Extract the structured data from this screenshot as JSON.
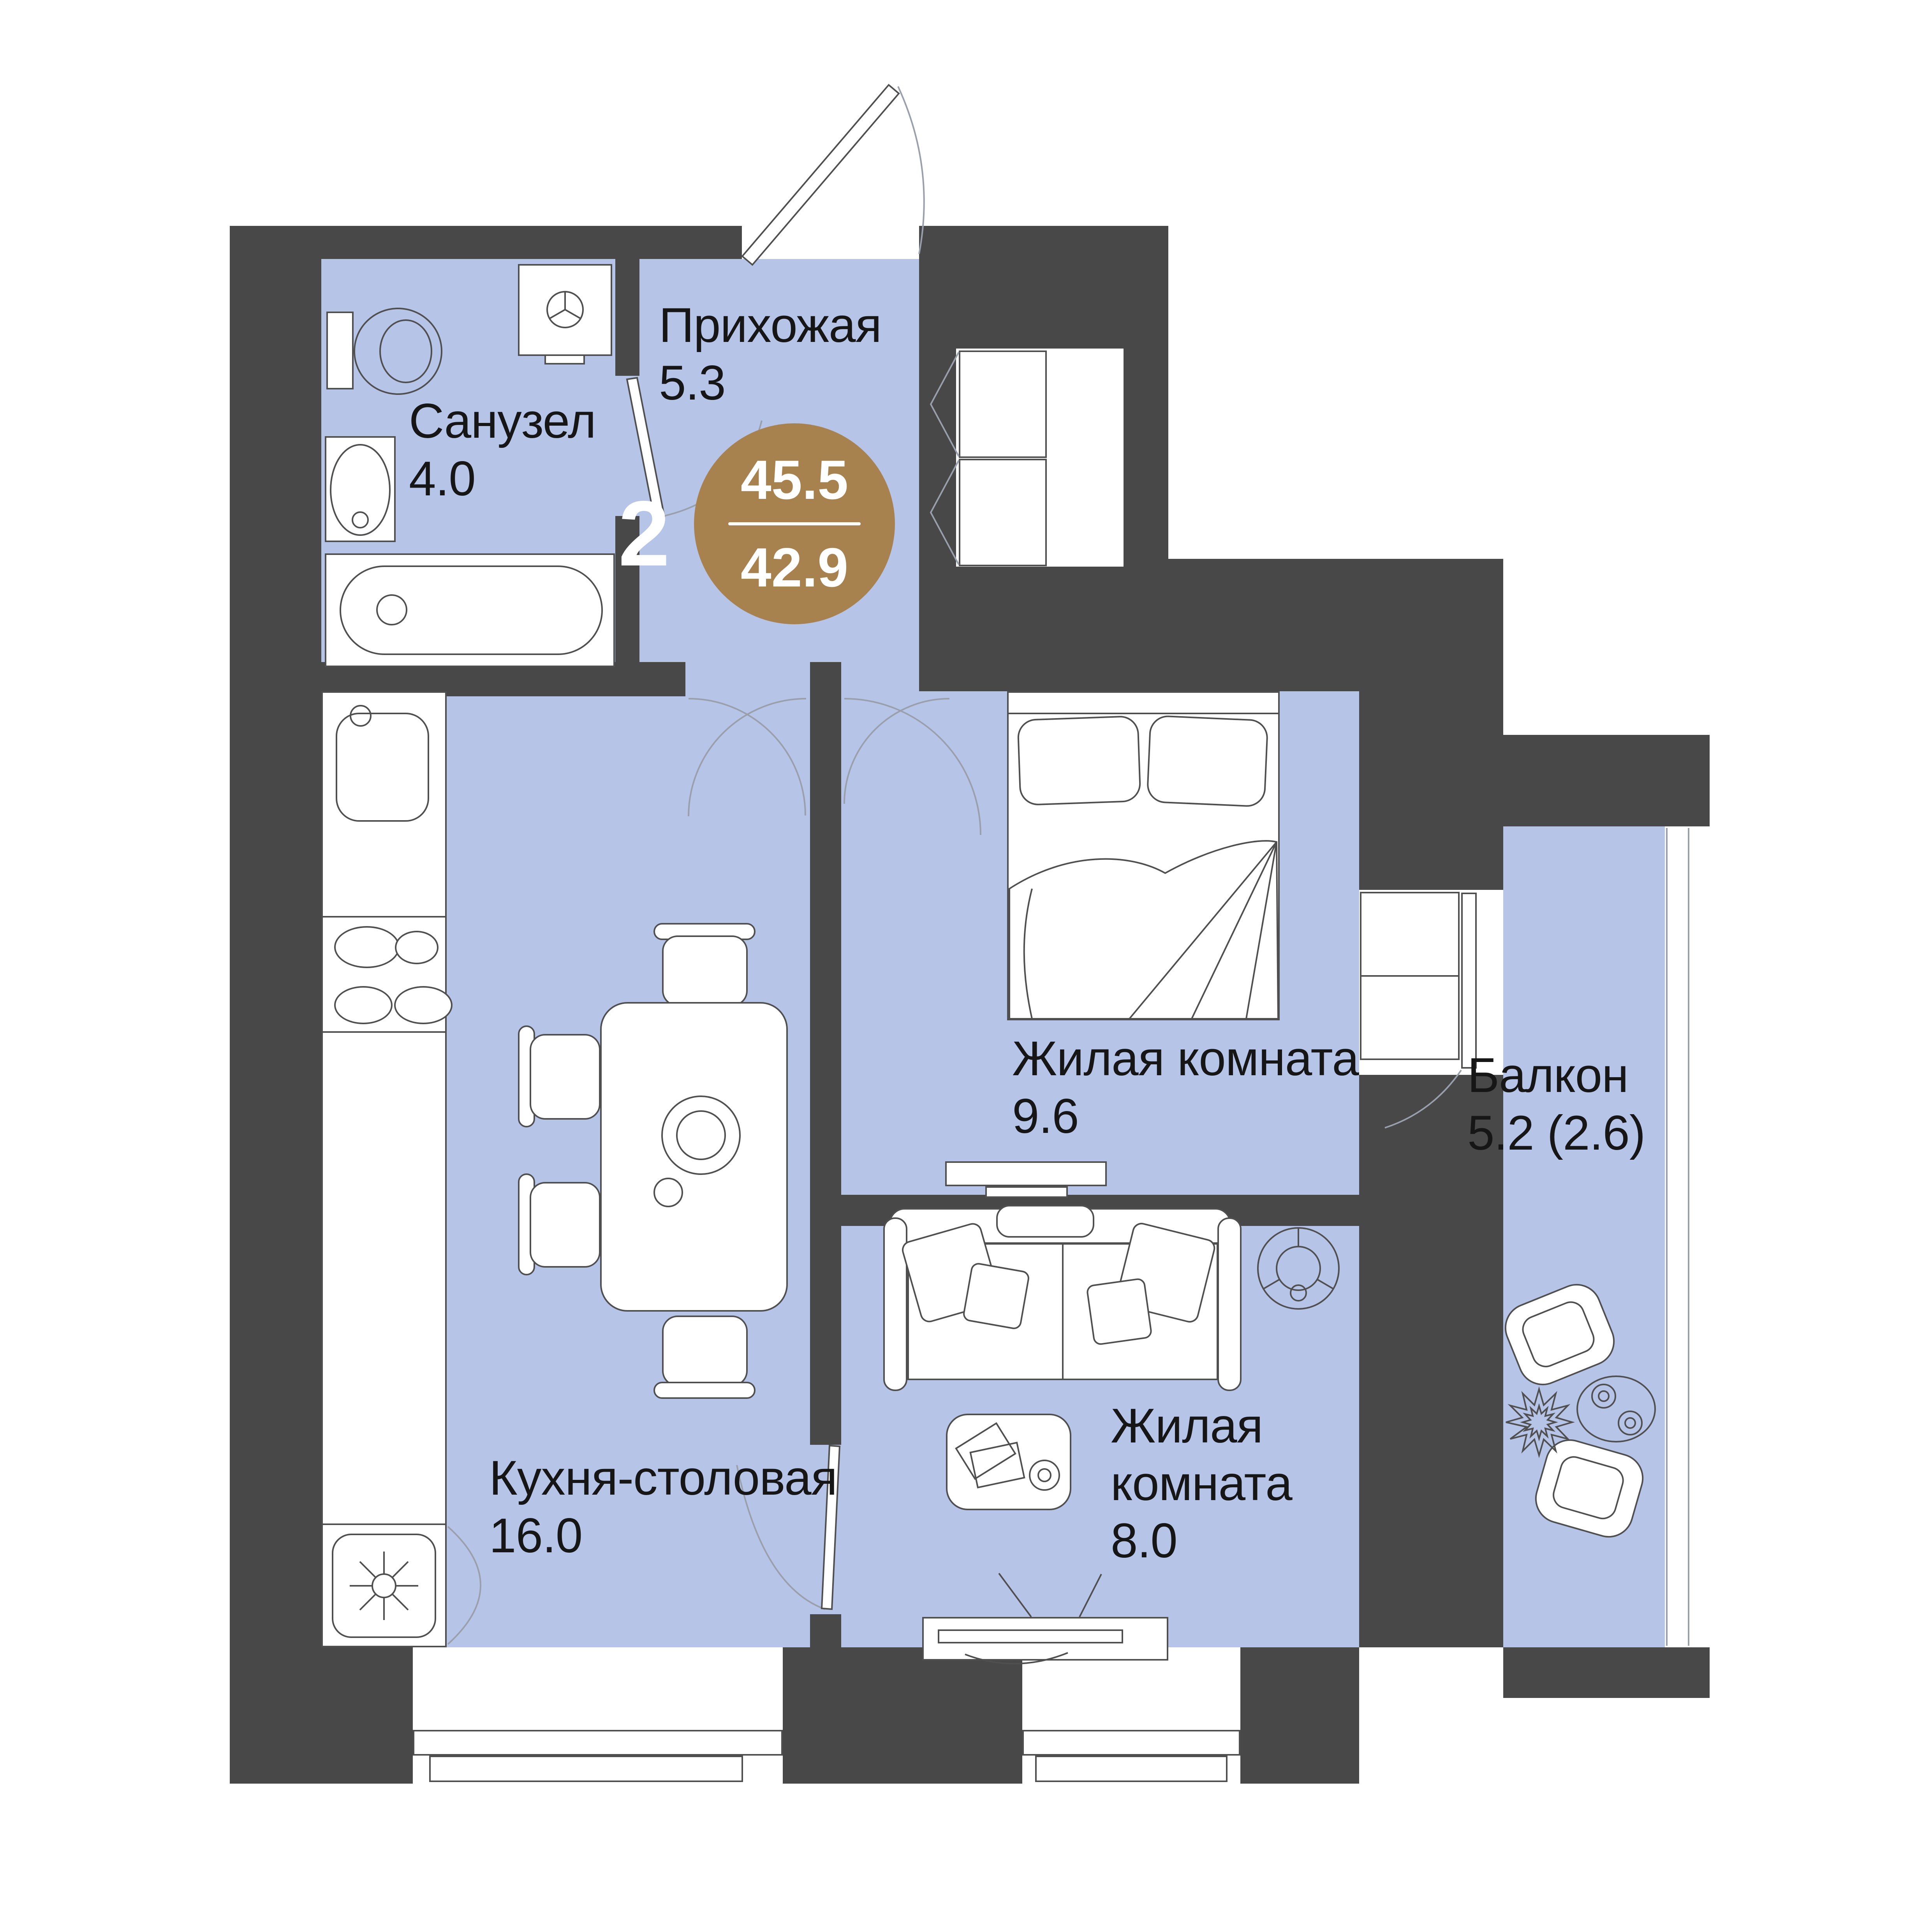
{
  "apartment": {
    "rooms_count": "2",
    "badge": {
      "total_area": "45.5",
      "living_area": "42.9"
    },
    "rooms": {
      "hallway": {
        "name": "Прихожая",
        "area": "5.3"
      },
      "bathroom": {
        "name": "Санузел",
        "area": "4.0"
      },
      "bedroom": {
        "name": "Жилая комната",
        "area": "9.6"
      },
      "balcony": {
        "name": "Балкон",
        "area": "5.2 (2.6)"
      },
      "kitchen": {
        "name": "Кухня-столовая",
        "area": "16.0"
      },
      "living_room": {
        "name_line1": "Жилая",
        "name_line2": "комната",
        "area": "8.0"
      }
    },
    "colors": {
      "wall": "#484848",
      "floor": "#b6c4e8",
      "accent": "#a8824e",
      "door_line": "#9aa0ab"
    },
    "fixtures": [
      "entrance-door-icon",
      "toilet-icon",
      "washing-machine-icon",
      "bathroom-sink-icon",
      "bathtub-icon",
      "hall-wardrobe-icon",
      "kitchen-sink-icon",
      "stove-icon",
      "fridge-icon",
      "dining-table-icon",
      "chair-icon",
      "bed-icon",
      "bedroom-wardrobe-icon",
      "tv-stand-icon",
      "sofa-icon",
      "floor-lamp-icon",
      "coffee-table-icon",
      "media-console-icon",
      "armchair-icon",
      "plant-icon",
      "balcony-table-icon",
      "window-icon",
      "balcony-glazing-icon"
    ]
  }
}
